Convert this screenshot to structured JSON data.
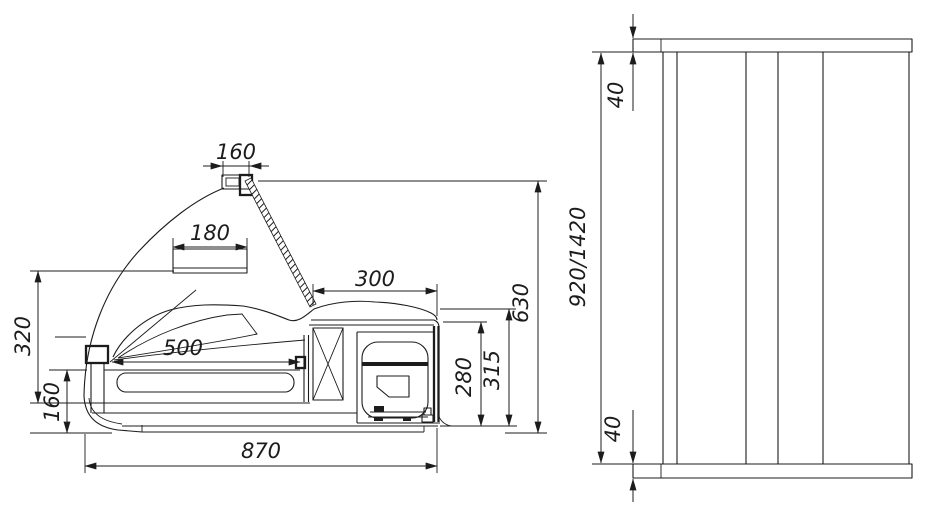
{
  "colors": {
    "ink": "#1c1c1c",
    "background": "#ffffff"
  },
  "views": {
    "side_view": {
      "label": "side-section-view",
      "dims": {
        "lamp_width": "160",
        "shelf_width": "180",
        "glass_front_height": "320",
        "front_panel_height": "160",
        "deck_length": "500",
        "machine_compartment_width": "300",
        "compressor_space_height": "280",
        "machine_compartment_height": "315",
        "overall_height": "630",
        "overall_depth": "870"
      }
    },
    "front_view": {
      "label": "stand-front-view",
      "dims": {
        "top_slab_thickness": "40",
        "bottom_slab_thickness": "40",
        "stand_height_variants": "920/1420"
      }
    }
  }
}
